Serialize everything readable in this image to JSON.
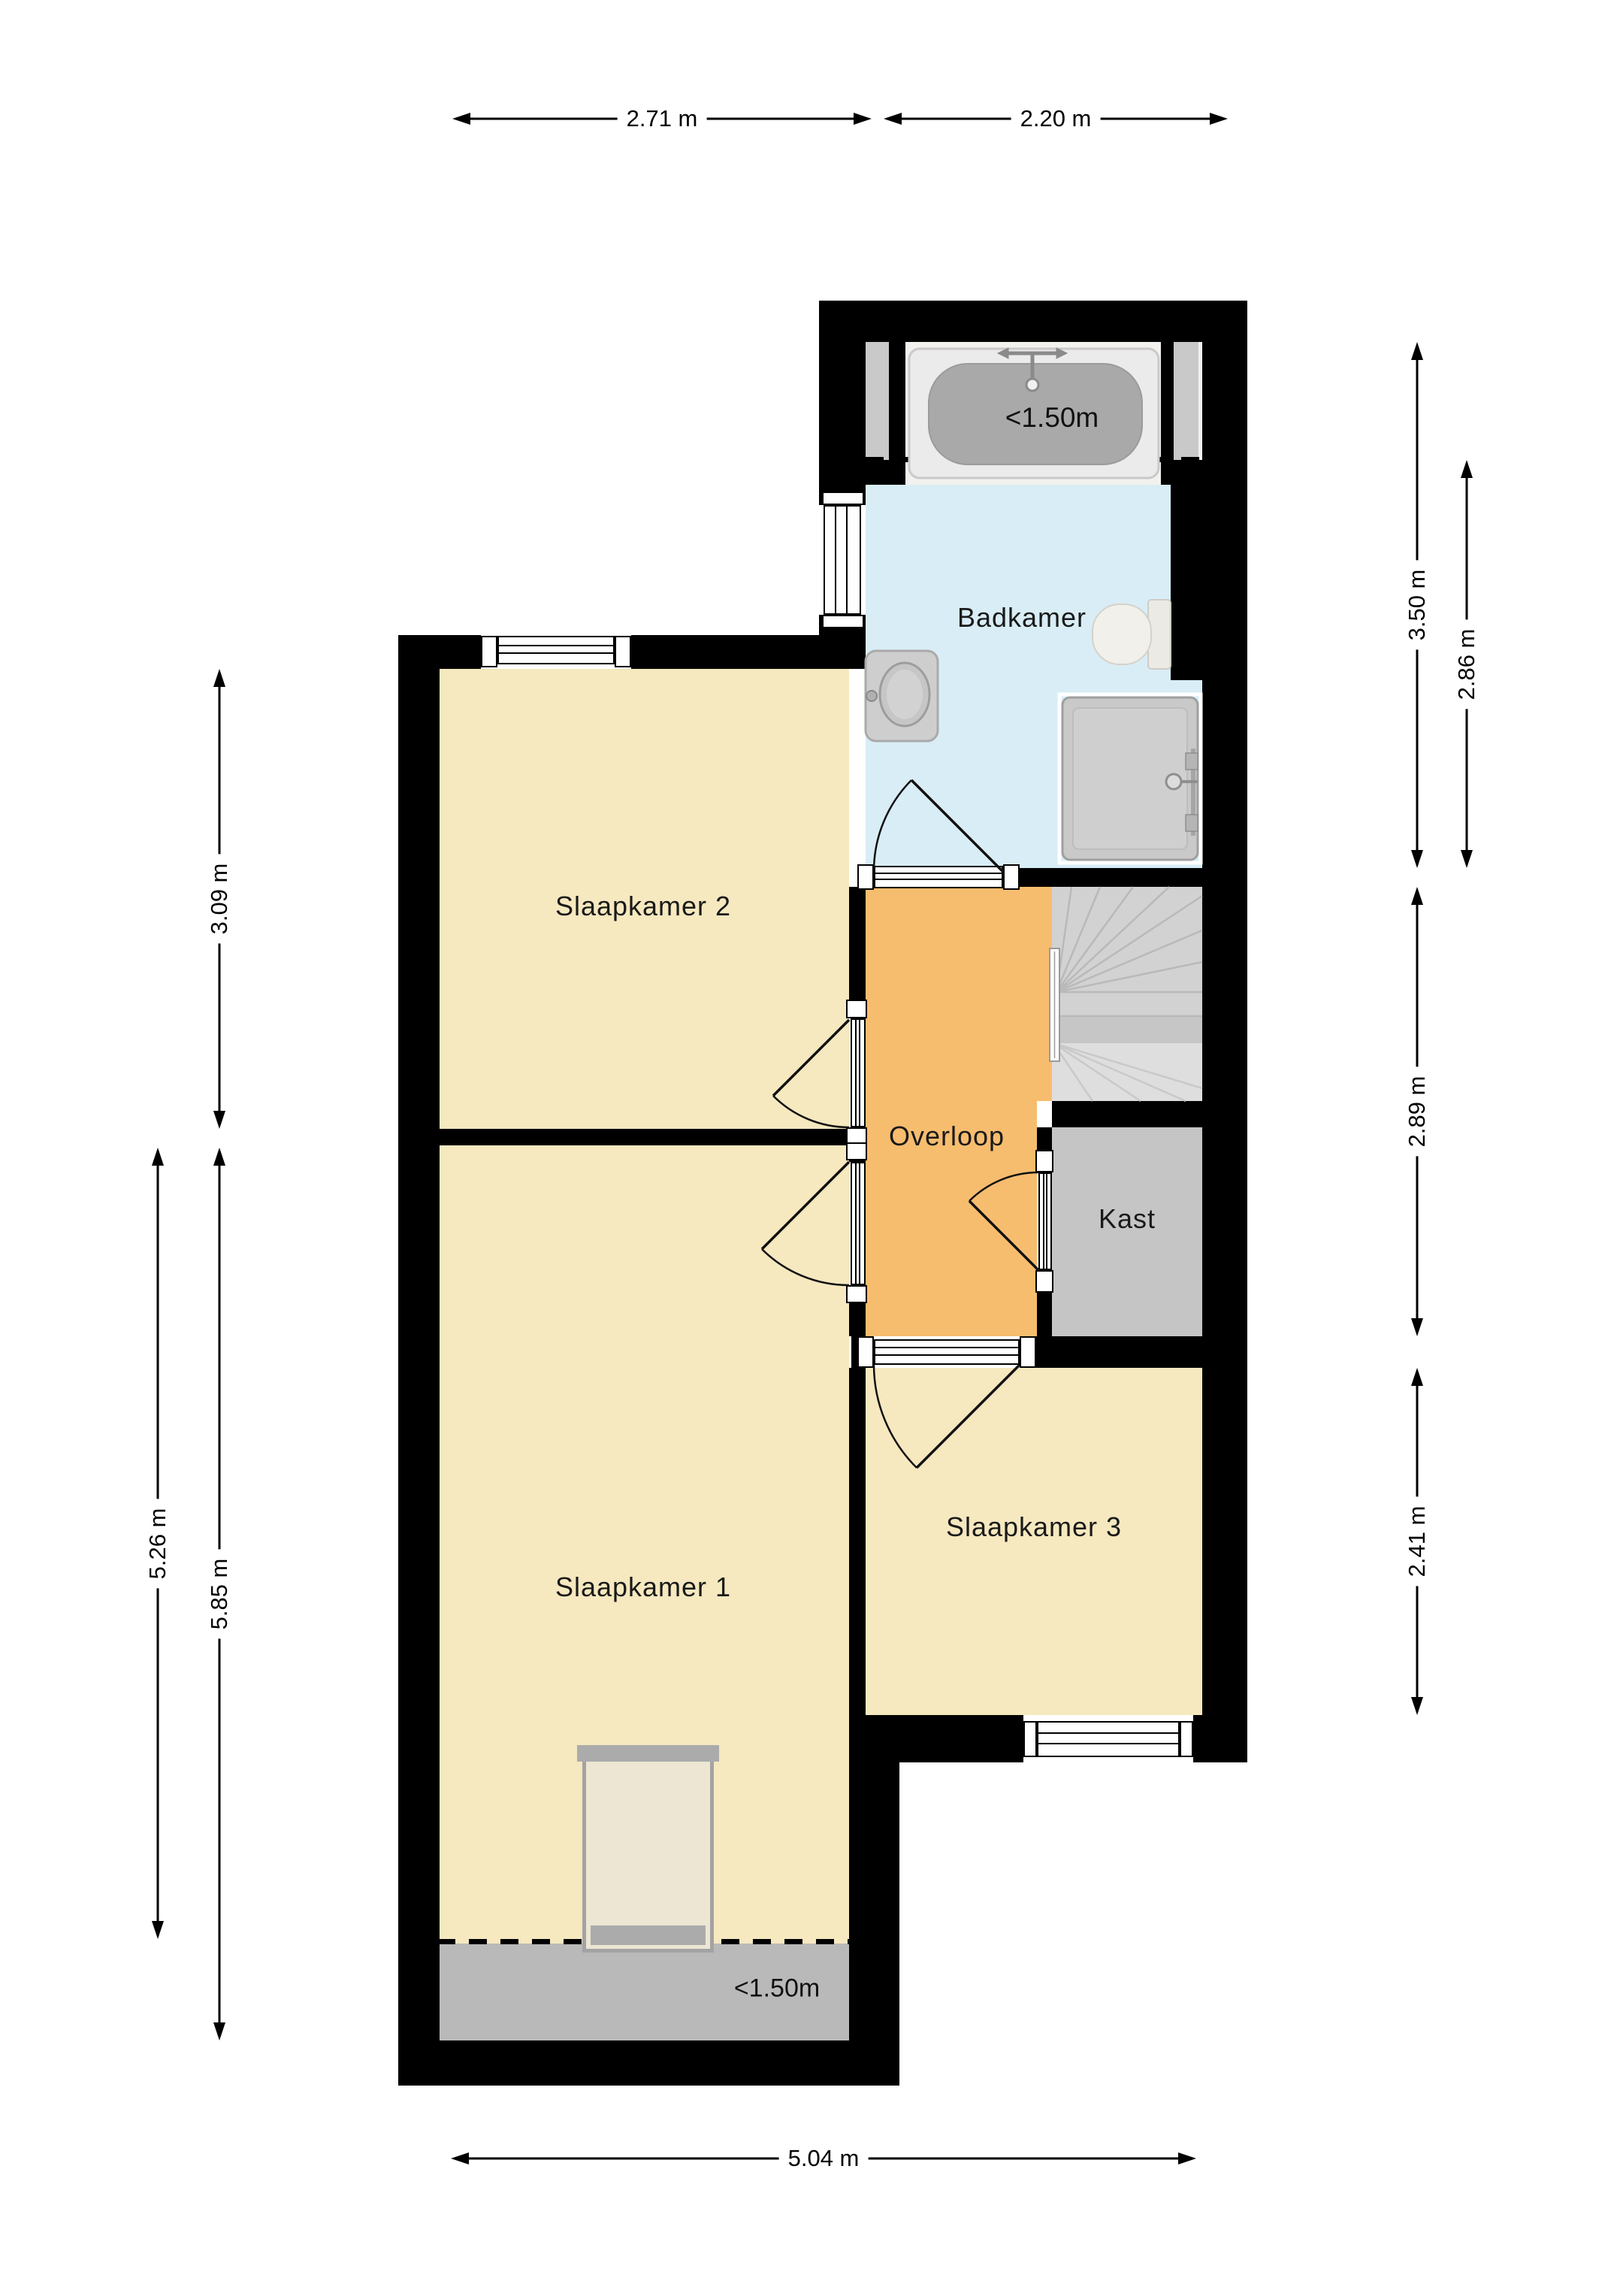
{
  "rooms": {
    "badkamer": {
      "label": "Badkamer",
      "color": "#d9edf6"
    },
    "slaapkamer2": {
      "label": "Slaapkamer 2",
      "color": "#f6e8bf"
    },
    "slaapkamer1": {
      "label": "Slaapkamer 1",
      "color": "#f6e8bf"
    },
    "slaapkamer3": {
      "label": "Slaapkamer 3",
      "color": "#f6e8bf"
    },
    "overloop": {
      "label": "Overloop",
      "color": "#f7bd6e"
    },
    "kast": {
      "label": "Kast",
      "color": "#c5c5c5"
    }
  },
  "annotations": {
    "badkamer_headroom": "<1.50m",
    "slaapkamer1_headroom": "<1.50m"
  },
  "dimensions": {
    "top_left": "2.71 m",
    "top_right": "2.20 m",
    "bottom": "5.04 m",
    "left_outer": "5.26 m",
    "left_inner_top": "3.09 m",
    "left_inner_bottom": "5.85 m",
    "right_inner_top": "3.50 m",
    "right_outer_top": "2.86 m",
    "right_inner_middle": "2.89 m",
    "right_inner_bottom": "2.41 m"
  },
  "colors": {
    "wall": "#000000",
    "stairs": "#d2d2d2",
    "headroom_zone": "#b9b9b9",
    "dimension_text": "#000000"
  }
}
